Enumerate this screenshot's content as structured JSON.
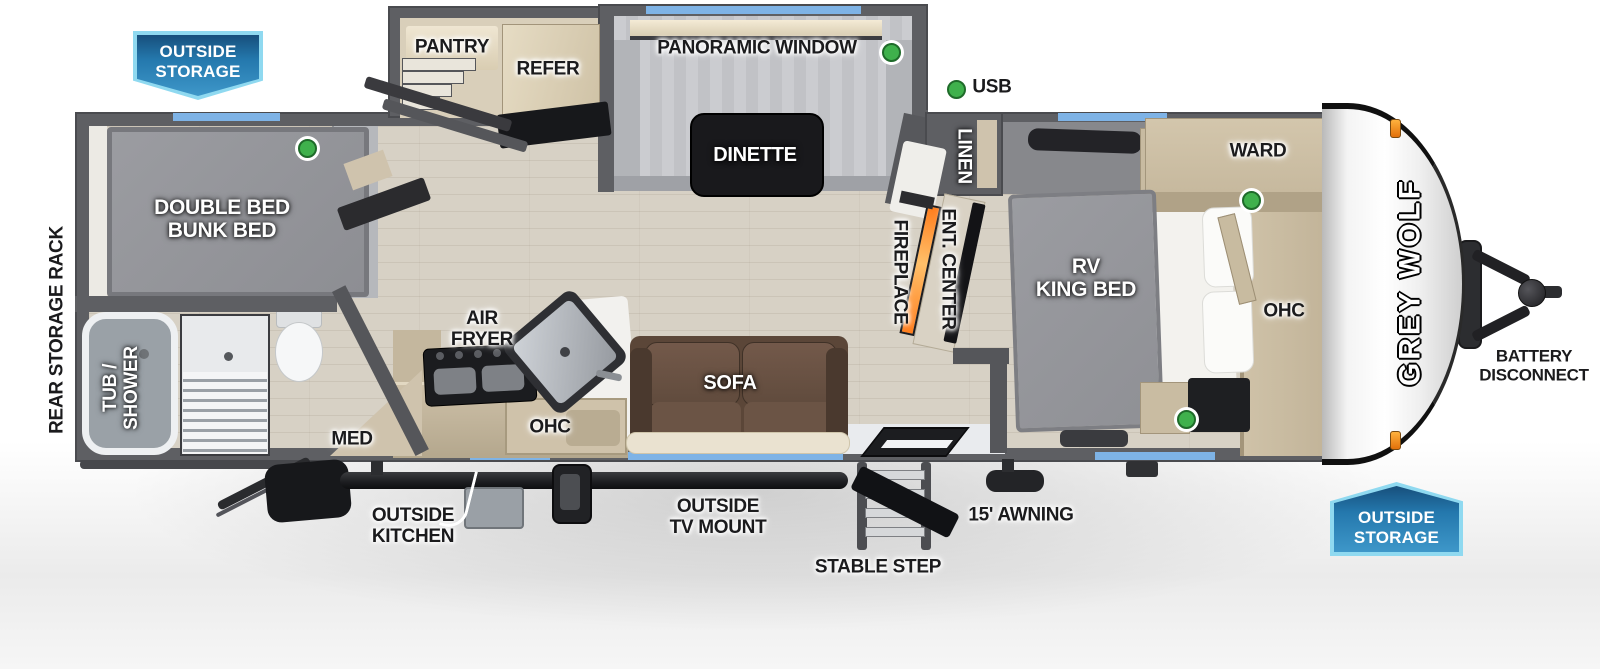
{
  "colors": {
    "banner_blue": "#2478ad",
    "banner_border": "#8fd9f0",
    "window_blue": "#7eb3e6",
    "led_green": "#3fb14c",
    "flame_orange": "#ff7d1c",
    "clearance_light_orange": "#f59a23",
    "wall_gray": "#5e5f63",
    "floor_wood": "#d7d1c5"
  },
  "banners": {
    "top_left": "OUTSIDE\nSTORAGE",
    "bottom_right": "OUTSIDE\nSTORAGE"
  },
  "legend": {
    "usb": "USB"
  },
  "brand": {
    "logo": "GREY WOLF"
  },
  "labels": {
    "pantry": "PANTRY",
    "refer": "REFER",
    "panoramic_window": "PANORAMIC WINDOW",
    "dinette": "DINETTE",
    "linen": "LINEN",
    "ward": "WARD",
    "fireplace": "FIREPLACE",
    "ent_center": "ENT. CENTER",
    "rv_king_bed": "RV\nKING BED",
    "ohc_bedroom": "OHC",
    "double_bunk": "DOUBLE BED\nBUNK BED",
    "rear_storage_rack": "REAR STORAGE RACK",
    "tub_shower": "TUB /\nSHOWER",
    "med": "MED",
    "air_fryer": "AIR\nFRYER",
    "ohc_kitchen": "OHC",
    "sofa": "SOFA",
    "outside_kitchen": "OUTSIDE\nKITCHEN",
    "outside_tv_mount": "OUTSIDE\nTV MOUNT",
    "stable_step": "STABLE STEP",
    "awning": "15' AWNING",
    "battery_disconnect": "BATTERY\nDISCONNECT"
  }
}
